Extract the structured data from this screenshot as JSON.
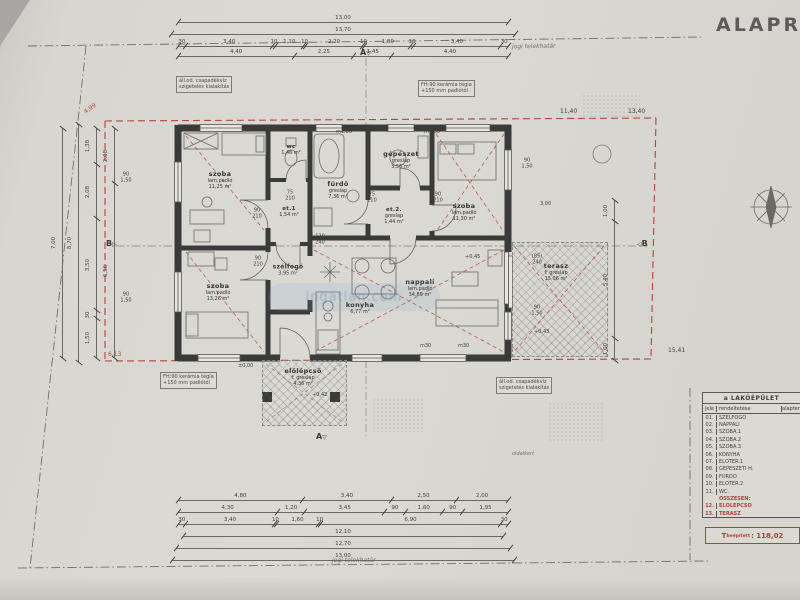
{
  "title": "ALAPRAJZ",
  "watermark": {
    "label": "ingatlan.com"
  },
  "boundary": {
    "label_top": "jogi telekhatár",
    "label_bottom": "jogi telekhatár",
    "side_label": "oldalkert"
  },
  "rooms": {
    "szoba1": {
      "name": "szoba",
      "floor": "lam.padló",
      "area": "11,25 m²"
    },
    "wc": {
      "name": "wc",
      "floor": "greslap",
      "area": "1,46 m²"
    },
    "furdo": {
      "name": "fürdő",
      "floor": "greslap",
      "area": "7,36 m²"
    },
    "gepeszet": {
      "name": "gépészet",
      "floor": "greslap",
      "area": "3,56 m²"
    },
    "szoba2": {
      "name": "szoba",
      "floor": "lam.padló",
      "area": "11,30 m²"
    },
    "et1": {
      "name": "et.1",
      "floor": "greslap",
      "area": "1,54 m²"
    },
    "et2": {
      "name": "et.2.",
      "floor": "greslap",
      "area": "1,44 m²"
    },
    "szoba3": {
      "name": "szoba",
      "floor": "lam.padló",
      "area": "13,26 m²"
    },
    "szelfogo": {
      "name": "szélfogó",
      "floor": "greslap",
      "area": "3,95 m²"
    },
    "konyha": {
      "name": "konyha",
      "floor": "greslap",
      "area": "6,77 m²"
    },
    "nappali": {
      "name": "nappali",
      "floor": "lam.padló",
      "area": "34,85 m²"
    },
    "terasz": {
      "name": "terasz",
      "floor": "f: greslap",
      "area": "15,06 m²"
    },
    "elolepcso": {
      "name": "előlépcső",
      "floor": "f: greslap",
      "area": "4,36 m²"
    }
  },
  "levels": {
    "l0": "±0,00",
    "l42": "+0,42",
    "l43": "+0,43",
    "l45": "+0,45"
  },
  "sections": {
    "a": "A",
    "b": "B"
  },
  "notes": {
    "fh_l1": "FH:90 kerámia tégla",
    "fh_l2": "+150 mm padlótól",
    "drain_l1": "áll.od. csapadékvíz",
    "drain_l2": "szigetelés kialakítás"
  },
  "dims": {
    "top_total1": [
      "13,00"
    ],
    "top_total2": [
      "13,70"
    ],
    "top_chain1": [
      "30",
      "3,40",
      "10",
      "1,10",
      "10",
      "2,20",
      "10",
      "1,80",
      "10",
      "3,40",
      "30"
    ],
    "top_chain2": [
      "4,40",
      "2,25",
      "1,45",
      "4,40"
    ],
    "bottom_chain1": [
      "4,80",
      "3,40",
      "2,50",
      "2,00"
    ],
    "bottom_chain2": [
      "4,30",
      "1,20",
      "3,45",
      "90",
      "1,60",
      "90",
      "1,95"
    ],
    "bottom_chain3": [
      "30",
      "3,40",
      "10",
      "1,60",
      "10",
      "6,90",
      "30"
    ],
    "bottom_total1": [
      "12,10"
    ],
    "bottom_total2": [
      "12,70"
    ],
    "bottom_total3": [
      "13,00"
    ],
    "left_total1": [
      "7,00"
    ],
    "left_total2": [
      "8,70"
    ],
    "left_chain1": [
      "1,38",
      "2,08",
      "3,50",
      "30",
      "1,50"
    ],
    "left_chain2": [
      "2,08",
      "6,56"
    ],
    "right_chain": [
      "1,00",
      "5,40",
      "1,00"
    ],
    "marks": {
      "m180": "m1,80",
      "m30": "m30",
      "p90": "90",
      "p150": "1,50",
      "p210": "210",
      "p75": "75",
      "p120": "120",
      "p240": "240",
      "p85": "(85)",
      "p300": "3,00",
      "p540": "5,40"
    },
    "red": {
      "tl": "4,99",
      "bl": "6,13",
      "tr2": "11,40",
      "tr": "13,40",
      "br": "15,41"
    }
  },
  "legend": {
    "title": "a LAKÓÉPÜLET",
    "col_jel": "jele",
    "col_name": "rendeltetése",
    "col_area": "alapterülete",
    "rows": [
      {
        "jel": "01.",
        "name": "SZÉLFOGÓ",
        "area": ""
      },
      {
        "jel": "02.",
        "name": "NAPPALI",
        "area": ""
      },
      {
        "jel": "03.",
        "name": "SZOBA.1",
        "area": ""
      },
      {
        "jel": "04.",
        "name": "SZOBA.2",
        "area": ""
      },
      {
        "jel": "05.",
        "name": "SZOBA.3",
        "area": ""
      },
      {
        "jel": "06.",
        "name": "KONYHA",
        "area": ""
      },
      {
        "jel": "07.",
        "name": "ELŐTÉR.1",
        "area": ""
      },
      {
        "jel": "08.",
        "name": "GÉPÉSZETI H.",
        "area": ""
      },
      {
        "jel": "09.",
        "name": "FÜRDŐ",
        "area": ""
      },
      {
        "jel": "10.",
        "name": "ELŐTÉR.2",
        "area": ""
      },
      {
        "jel": "11.",
        "name": "WC.",
        "area": ""
      },
      {
        "jel": "",
        "name": "ÖSSZESEN:",
        "area": "",
        "red": true
      },
      {
        "jel": "12.",
        "name": "ELŐLÉPCSŐ",
        "area": "",
        "red": true
      },
      {
        "jel": "13.",
        "name": "TERASZ",
        "area": "",
        "red": true
      }
    ],
    "total_t": "T",
    "total_sub": "beépített",
    "total_value": ": 118,02"
  }
}
